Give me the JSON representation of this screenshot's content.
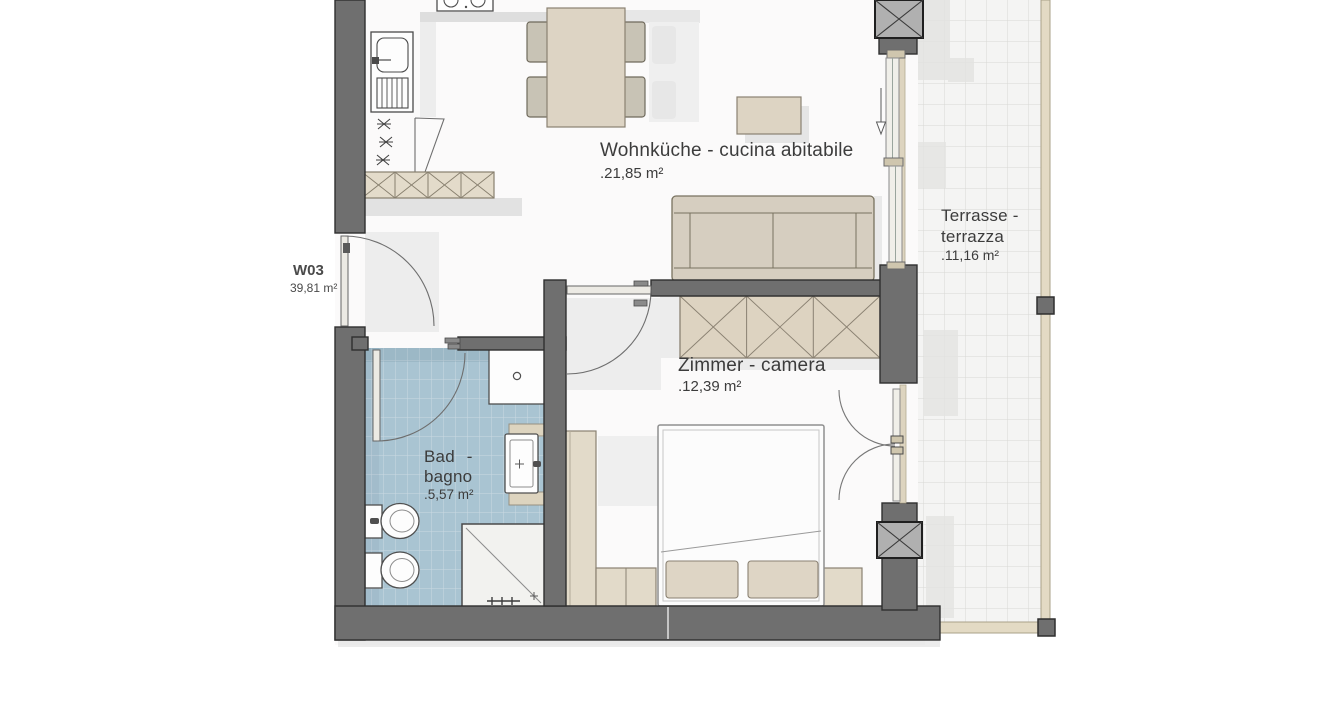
{
  "plan": {
    "unit": {
      "label": "W03",
      "area": "39,81 m²"
    },
    "rooms": {
      "living": {
        "name": "Wohnküche - cucina abitabile",
        "area": ".21,85 m²"
      },
      "bedroom": {
        "name": "Zimmer - camera",
        "area": ".12,39 m²"
      },
      "bath": {
        "name_line1": "Bad -",
        "name_line2": "bagno",
        "area": ".5,57 m²"
      },
      "terrace": {
        "name_line1": "Terrasse -",
        "name_line2": "terrazza",
        "area": ".11,16 m²"
      }
    },
    "colors": {
      "wall": "#6f6f6f",
      "furniture": "#ddd4c3",
      "bath_tile": "#a9c4d2",
      "terrace": "#f4f4f3",
      "railing": "#e3dac4",
      "text": "#3c3c3c"
    }
  }
}
